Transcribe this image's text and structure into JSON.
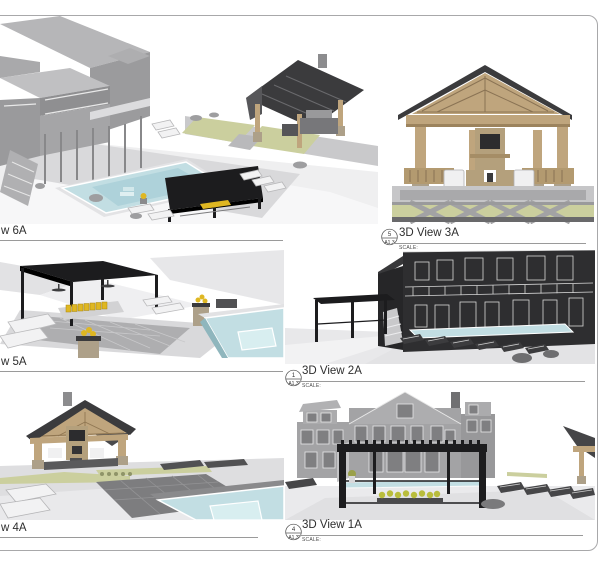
{
  "sheet": {
    "background": "#ffffff",
    "border_color": "#a8a8aa"
  },
  "views": {
    "v6a": {
      "title_fragment": "w 6A"
    },
    "v5a": {
      "title_fragment": "w 5A"
    },
    "v4a": {
      "title_fragment": "w 4A"
    },
    "v3a": {
      "title": "3D View 3A",
      "ref_number": "5",
      "ref_sheet": "A1.3",
      "scale_label": "SCALE:"
    },
    "v2a": {
      "title": "3D View 2A",
      "ref_number": "1",
      "ref_sheet": "A1.3",
      "scale_label": "SCALE:"
    },
    "v1a": {
      "title": "3D View 1A",
      "ref_number": "4",
      "ref_sheet": "A1.3",
      "scale_label": "SCALE:"
    }
  },
  "palette": {
    "pool": "#c2dee3",
    "pool_deep": "#aed2da",
    "black": "#1c1c1e",
    "wood": "#bfa57d",
    "darkroof": "#3b3b3d",
    "grass": "#cbcf9e",
    "house": "#a3a3a5",
    "darkhouse": "#2e2e30",
    "stone": "#ada089",
    "yellow": "#dfb722",
    "ground": "#ededef"
  }
}
